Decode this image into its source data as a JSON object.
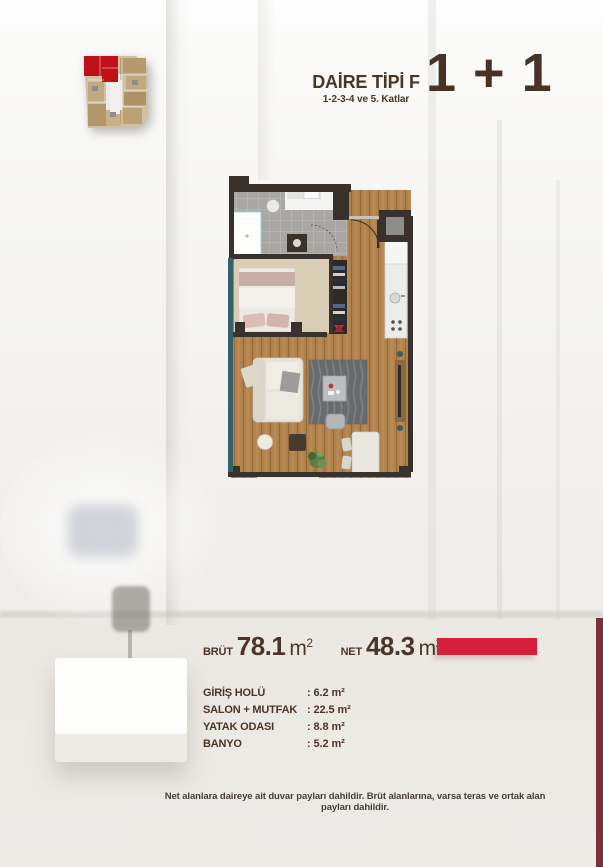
{
  "header": {
    "title": "DAİRE TİPİ F",
    "subtitle": "1-2-3-4 ve 5. Katlar",
    "type_label": "1 + 1"
  },
  "areas": {
    "brut_label": "BRÜT",
    "brut_value": "78.1",
    "net_label": "NET",
    "net_value": "48.3",
    "unit": "m",
    "unit_sup": "2"
  },
  "rooms": [
    {
      "label": "GİRİŞ HOLÜ",
      "value": ": 6.2 m²"
    },
    {
      "label": "SALON + MUTFAK",
      "value": ": 22.5 m²"
    },
    {
      "label": "YATAK ODASI",
      "value": ": 8.8 m²"
    },
    {
      "label": "BANYO",
      "value": ": 5.2 m²"
    }
  ],
  "footer": {
    "note": "Net alanlara daireye ait duvar payları dahildir. Brüt alanlarına, varsa teras ve ortak alan payları dahildir."
  },
  "colors": {
    "accent_red": "#d5203b",
    "edge_bar_maroon": "#7e2d3a",
    "text_brown": "#4a3526",
    "key_plan_red": "#bf1117"
  }
}
